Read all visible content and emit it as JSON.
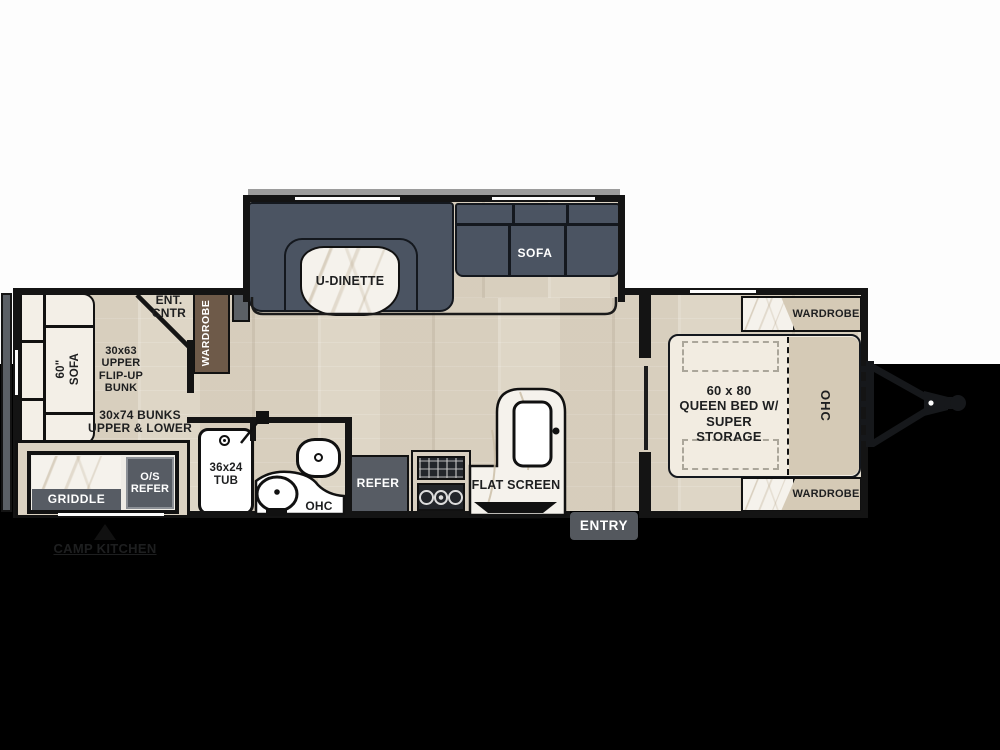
{
  "plan_type": "travel-trailer-floorplan",
  "colors": {
    "background": "#000000",
    "paper": "#fdfdfd",
    "wall": "#141414",
    "wood_floor": "#ded6c6",
    "dark_furniture": "#4b5462",
    "appliance_gray": "#575c64",
    "wardrobe_brown": "#6e5a49",
    "cabinet_beige": "#d5cab6",
    "bed_cream": "#f2ece1",
    "marble": "#f5f2ec"
  },
  "slideout": {
    "dinette_label": "U-DINETTE",
    "sofa_label": "SOFA"
  },
  "rear": {
    "sofa_label": "60\"\nSOFA",
    "flip_bunk_label": "30x63\nUPPER\nFLIP-UP\nBUNK",
    "bunks_label": "30x74 BUNKS\nUPPER & LOWER",
    "ent_cntr_label": "ENT.\nCNTR",
    "wardrobe_label": "WARDROBE"
  },
  "camp_kitchen": {
    "griddle_label": "GRIDDLE",
    "os_refer_label": "O/S\nREFER",
    "caption": "CAMP KITCHEN"
  },
  "bath": {
    "tub_label": "36x24\nTUB",
    "ohc_label": "OHC"
  },
  "kitchen": {
    "refer_label": "REFER",
    "flat_screen_label": "FLAT SCREEN"
  },
  "entry": {
    "label": "ENTRY"
  },
  "bedroom": {
    "bed_label": "60 x 80\nQUEEN BED W/\nSUPER STORAGE",
    "ohc_label": "OHC",
    "wardrobe_top_label": "WARDROBE",
    "wardrobe_bottom_label": "WARDROBE"
  }
}
